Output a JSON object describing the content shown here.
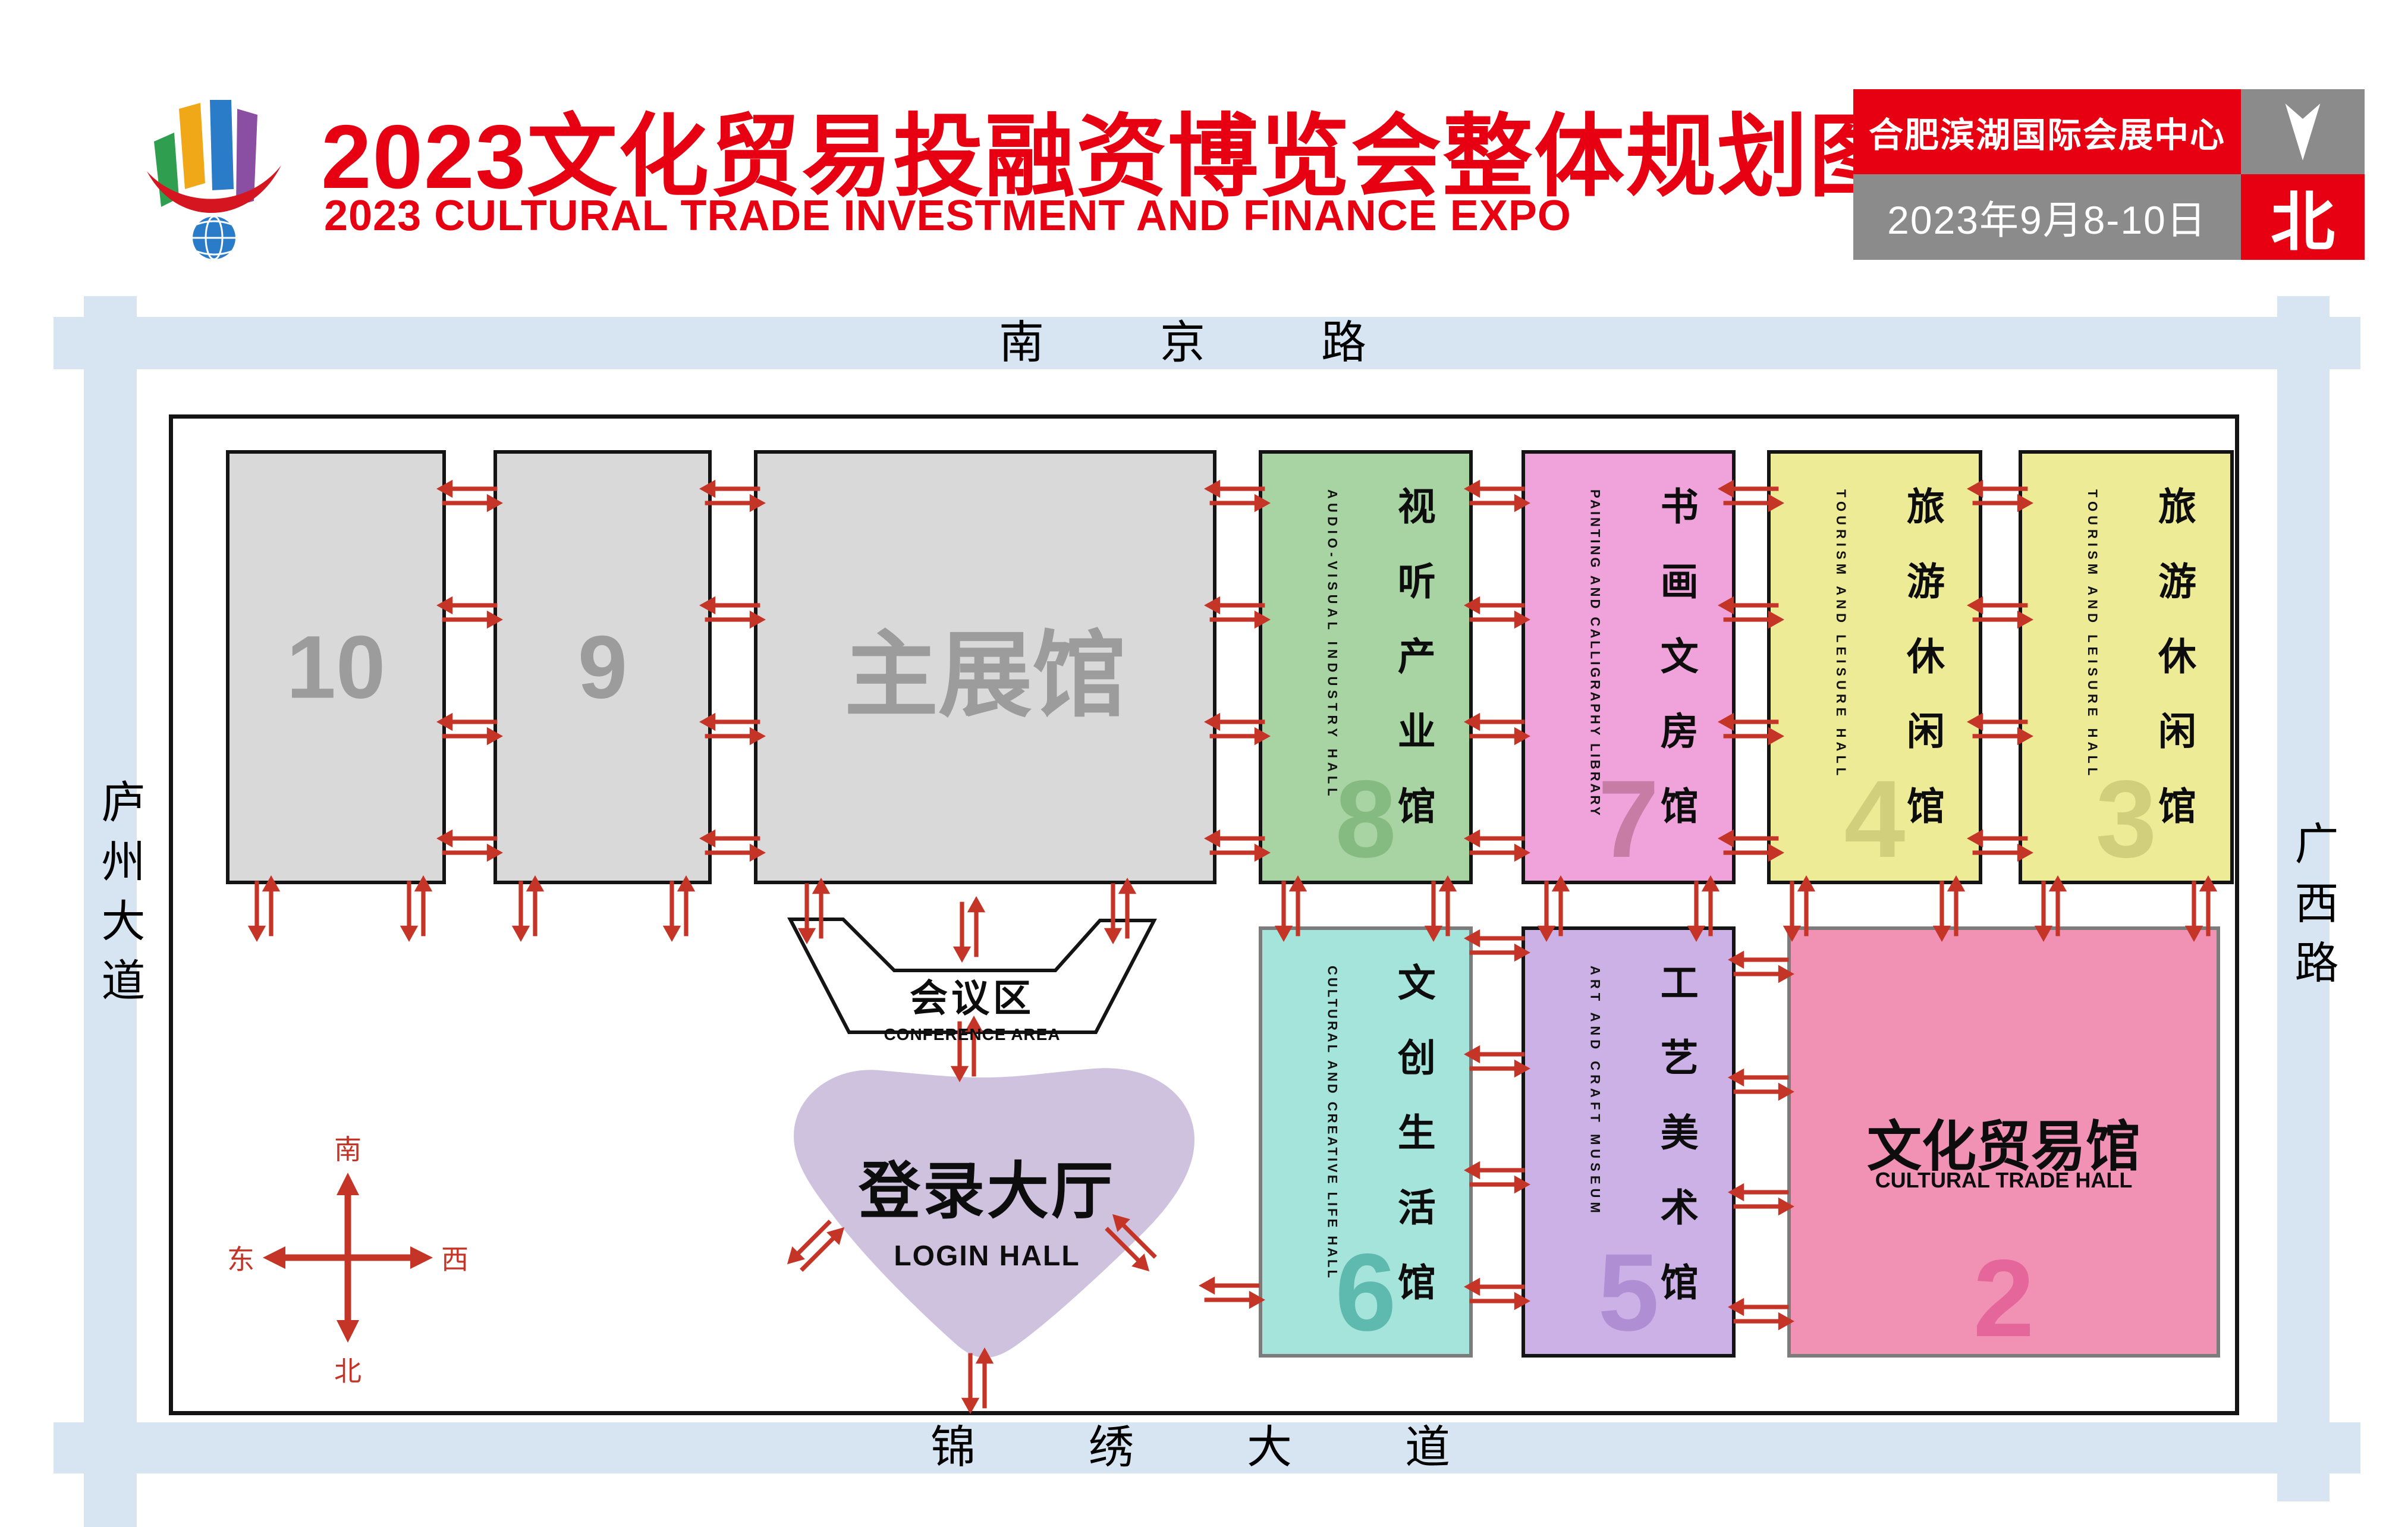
{
  "header": {
    "title_cn": "2023文化贸易投融资博览会整体规划图",
    "title_en": "2023 CULTURAL TRADE INVESTMENT AND FINANCE EXPO",
    "badge": {
      "venue": "合肥滨湖国际会展中心",
      "dates": "2023年9月8-10日",
      "north_char": "北"
    },
    "title_color": "#e60012"
  },
  "roads": {
    "top": "南京路",
    "bottom": "锦绣大道",
    "left": "庐州大道",
    "right": "广西路",
    "road_color": "#d7e4f2"
  },
  "compass": {
    "top": "南",
    "bottom": "北",
    "left": "东",
    "right": "西",
    "color": "#c43427"
  },
  "halls": {
    "h10": {
      "number": "10",
      "color": "#d9d9d9",
      "number_color": "#9c9c9c"
    },
    "h9": {
      "number": "9",
      "color": "#d9d9d9",
      "number_color": "#9c9c9c"
    },
    "main": {
      "name_cn": "主展馆",
      "color": "#d9d9d9",
      "text_color": "#9c9c9c"
    },
    "h8": {
      "number": "8",
      "name_cn": "视听产业馆",
      "name_en": "AUDIO-VISUAL INDUSTRY HALL",
      "color": "#a8d3a2",
      "number_color": "#85bb80"
    },
    "h7": {
      "number": "7",
      "name_cn": "书画文房馆",
      "name_en": "PAINTING AND CALLIGRAPHY LIBRARY",
      "color": "#f0a2da",
      "number_color": "#c77ca6"
    },
    "h4": {
      "number": "4",
      "name_cn": "旅游休闲馆",
      "name_en": "TOURISM AND LEISURE HALL",
      "color": "#eeeb97",
      "number_color": "#d2cf7c"
    },
    "h3": {
      "number": "3",
      "name_cn": "旅游休闲馆",
      "name_en": "TOURISM AND LEISURE HALL",
      "color": "#eeeb97",
      "number_color": "#d2cf7c"
    },
    "h6": {
      "number": "6",
      "name_cn": "文创生活馆",
      "name_en": "CULTURAL AND CREATIVE LIFE HALL",
      "color": "#a4e4db",
      "number_color": "#5eb9ae"
    },
    "h5": {
      "number": "5",
      "name_cn": "工艺美术馆",
      "name_en": "ART AND CRAFT MUSEUM",
      "color": "#ccb1e6",
      "number_color": "#af8ed3"
    },
    "h2": {
      "number": "2",
      "name_cn": "文化贸易馆",
      "name_en": "CULTURAL TRADE HALL",
      "color": "#f192b5",
      "number_color": "#e4669a"
    }
  },
  "facilities": {
    "conference": {
      "name_cn": "会议区",
      "name_en": "CONFERENCE AREA"
    },
    "login": {
      "name_cn": "登录大厅",
      "name_en": "LOGIN HALL",
      "color": "#cfc2de"
    }
  },
  "arrow_color": "#c43427"
}
